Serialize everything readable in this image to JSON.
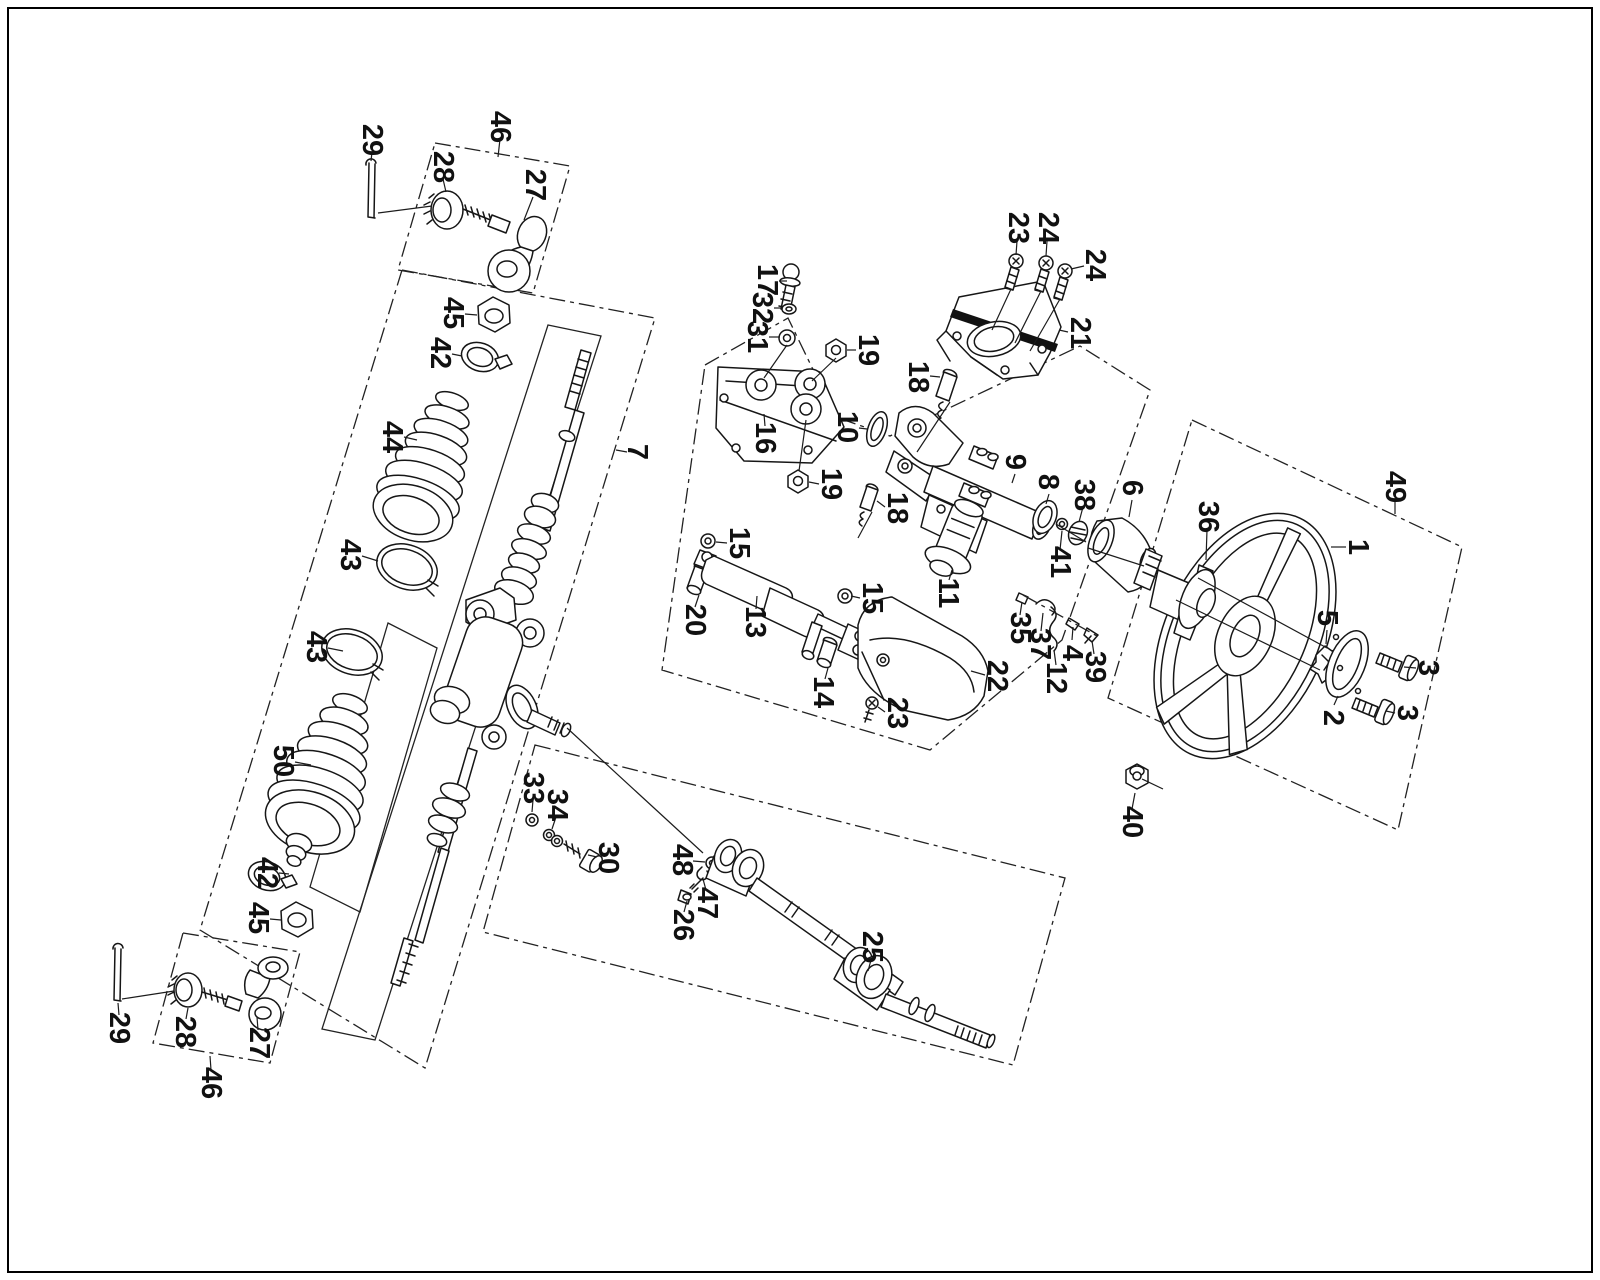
{
  "figure": {
    "title": "steering-system-exploded-parts-diagram",
    "width": 1600,
    "height": 1280,
    "background": "#ffffff",
    "ink": "#161616",
    "border": {
      "x": 8,
      "y": 8,
      "w": 1584,
      "h": 1264
    }
  },
  "labels": [
    {
      "t": "29",
      "x": 372,
      "y": 140,
      "l": [
        372,
        152,
        371,
        161
      ]
    },
    {
      "t": "46",
      "x": 500,
      "y": 127,
      "l": [
        500,
        139,
        498,
        157
      ]
    },
    {
      "t": "28",
      "x": 443,
      "y": 167,
      "l": [
        443,
        179,
        446,
        192
      ]
    },
    {
      "t": "27",
      "x": 535,
      "y": 185,
      "l": [
        533,
        197,
        524,
        220
      ]
    },
    {
      "t": "45",
      "x": 453,
      "y": 313,
      "l": [
        465,
        314,
        477,
        315
      ]
    },
    {
      "t": "42",
      "x": 440,
      "y": 353,
      "l": [
        452,
        354,
        462,
        356
      ]
    },
    {
      "t": "44",
      "x": 392,
      "y": 437,
      "l": [
        404,
        437,
        417,
        440
      ]
    },
    {
      "t": "43",
      "x": 350,
      "y": 555,
      "l": [
        362,
        556,
        378,
        561
      ]
    },
    {
      "t": "43",
      "x": 316,
      "y": 647,
      "l": [
        328,
        648,
        343,
        651
      ]
    },
    {
      "t": "50",
      "x": 283,
      "y": 761,
      "l": [
        295,
        762,
        311,
        765
      ]
    },
    {
      "t": "42",
      "x": 267,
      "y": 873,
      "l": [
        279,
        873,
        289,
        874
      ]
    },
    {
      "t": "45",
      "x": 258,
      "y": 918,
      "l": [
        270,
        919,
        281,
        920
      ]
    },
    {
      "t": "29",
      "x": 119,
      "y": 1028,
      "l": [
        119,
        1015,
        118,
        1003
      ]
    },
    {
      "t": "28",
      "x": 185,
      "y": 1032,
      "l": [
        186,
        1019,
        188,
        1008
      ]
    },
    {
      "t": "27",
      "x": 259,
      "y": 1043,
      "l": [
        258,
        1030,
        257,
        1017
      ]
    },
    {
      "t": "46",
      "x": 211,
      "y": 1083,
      "l": [
        211,
        1070,
        210,
        1056
      ]
    },
    {
      "t": "7",
      "x": 637,
      "y": 452,
      "l": [
        627,
        452,
        616,
        450
      ]
    },
    {
      "t": "17",
      "x": 767,
      "y": 280,
      "l": [
        779,
        281,
        787,
        281
      ]
    },
    {
      "t": "32",
      "x": 762,
      "y": 308,
      "l": [
        774,
        308,
        783,
        308
      ]
    },
    {
      "t": "31",
      "x": 757,
      "y": 337,
      "l": [
        769,
        337,
        780,
        337
      ]
    },
    {
      "t": "19",
      "x": 868,
      "y": 350,
      "l": [
        856,
        350,
        847,
        350
      ]
    },
    {
      "t": "16",
      "x": 765,
      "y": 438,
      "l": [
        765,
        426,
        764,
        414
      ]
    },
    {
      "t": "10",
      "x": 847,
      "y": 427,
      "l": [
        859,
        428,
        867,
        429
      ]
    },
    {
      "t": "19",
      "x": 831,
      "y": 484,
      "l": [
        819,
        484,
        809,
        482
      ]
    },
    {
      "t": "18",
      "x": 918,
      "y": 377,
      "l": [
        930,
        376,
        940,
        377
      ]
    },
    {
      "t": "18",
      "x": 897,
      "y": 508,
      "l": [
        885,
        507,
        877,
        501
      ]
    },
    {
      "t": "23",
      "x": 1018,
      "y": 228,
      "l": [
        1017,
        241,
        1016,
        255
      ]
    },
    {
      "t": "24",
      "x": 1048,
      "y": 228,
      "l": [
        1047,
        241,
        1046,
        256
      ]
    },
    {
      "t": "24",
      "x": 1095,
      "y": 265,
      "l": [
        1084,
        266,
        1071,
        269
      ]
    },
    {
      "t": "21",
      "x": 1080,
      "y": 333,
      "l": [
        1068,
        332,
        1059,
        330
      ]
    },
    {
      "t": "9",
      "x": 1015,
      "y": 462,
      "l": [
        1015,
        474,
        1012,
        483
      ]
    },
    {
      "t": "8",
      "x": 1048,
      "y": 482,
      "l": [
        1049,
        494,
        1046,
        504
      ]
    },
    {
      "t": "38",
      "x": 1084,
      "y": 495,
      "l": [
        1083,
        507,
        1079,
        522
      ]
    },
    {
      "t": "41",
      "x": 1060,
      "y": 562,
      "l": [
        1060,
        550,
        1062,
        531
      ]
    },
    {
      "t": "6",
      "x": 1132,
      "y": 488,
      "l": [
        1132,
        500,
        1129,
        517
      ]
    },
    {
      "t": "36",
      "x": 1208,
      "y": 517,
      "l": [
        1207,
        530,
        1206,
        560
      ]
    },
    {
      "t": "11",
      "x": 948,
      "y": 593,
      "l": [
        949,
        580,
        952,
        570
      ]
    },
    {
      "t": "15",
      "x": 739,
      "y": 543,
      "l": [
        727,
        543,
        716,
        542
      ]
    },
    {
      "t": "20",
      "x": 695,
      "y": 620,
      "l": [
        695,
        607,
        699,
        595
      ]
    },
    {
      "t": "13",
      "x": 755,
      "y": 622,
      "l": [
        756,
        609,
        757,
        596
      ]
    },
    {
      "t": "15",
      "x": 872,
      "y": 598,
      "l": [
        860,
        598,
        851,
        596
      ]
    },
    {
      "t": "14",
      "x": 823,
      "y": 692,
      "l": [
        825,
        679,
        828,
        668
      ]
    },
    {
      "t": "22",
      "x": 997,
      "y": 676,
      "l": [
        985,
        675,
        971,
        671
      ]
    },
    {
      "t": "23",
      "x": 897,
      "y": 713,
      "l": [
        885,
        712,
        878,
        707
      ]
    },
    {
      "t": "35",
      "x": 1020,
      "y": 628,
      "l": [
        1020,
        615,
        1022,
        602
      ]
    },
    {
      "t": "37",
      "x": 1040,
      "y": 644,
      "l": [
        1041,
        631,
        1043,
        613
      ]
    },
    {
      "t": "4",
      "x": 1072,
      "y": 653,
      "l": [
        1072,
        640,
        1073,
        627
      ]
    },
    {
      "t": "39",
      "x": 1095,
      "y": 667,
      "l": [
        1094,
        654,
        1092,
        641
      ]
    },
    {
      "t": "12",
      "x": 1056,
      "y": 678,
      "l": [
        1056,
        665,
        1054,
        650
      ]
    },
    {
      "t": "33",
      "x": 533,
      "y": 788,
      "l": [
        533,
        800,
        532,
        812
      ]
    },
    {
      "t": "34",
      "x": 557,
      "y": 805,
      "l": [
        556,
        817,
        552,
        829
      ]
    },
    {
      "t": "30",
      "x": 608,
      "y": 858,
      "l": [
        597,
        857,
        588,
        855
      ]
    },
    {
      "t": "48",
      "x": 682,
      "y": 860,
      "l": [
        693,
        861,
        705,
        862
      ]
    },
    {
      "t": "47",
      "x": 707,
      "y": 903,
      "l": [
        706,
        890,
        703,
        879
      ]
    },
    {
      "t": "26",
      "x": 683,
      "y": 925,
      "l": [
        684,
        912,
        687,
        901
      ]
    },
    {
      "t": "25",
      "x": 872,
      "y": 947,
      "l": [
        871,
        960,
        868,
        971
      ]
    },
    {
      "t": "49",
      "x": 1395,
      "y": 487,
      "l": [
        1395,
        499,
        1395,
        514
      ]
    },
    {
      "t": "1",
      "x": 1358,
      "y": 547,
      "l": [
        1346,
        547,
        1331,
        547
      ]
    },
    {
      "t": "5",
      "x": 1327,
      "y": 618,
      "l": [
        1327,
        630,
        1326,
        644
      ]
    },
    {
      "t": "2",
      "x": 1333,
      "y": 718,
      "l": [
        1334,
        705,
        1338,
        696
      ]
    },
    {
      "t": "3",
      "x": 1428,
      "y": 668,
      "l": [
        1416,
        668,
        1404,
        667
      ]
    },
    {
      "t": "3",
      "x": 1407,
      "y": 713,
      "l": [
        1395,
        713,
        1386,
        711
      ]
    },
    {
      "t": "40",
      "x": 1132,
      "y": 822,
      "l": [
        1132,
        809,
        1135,
        793
      ]
    }
  ],
  "leader_lines": {
    "solid": [
      [
        378,
        213,
        432,
        206
      ],
      [
        122,
        999,
        174,
        991
      ],
      [
        787,
        345,
        764,
        378
      ],
      [
        836,
        358,
        812,
        381
      ],
      [
        799,
        471,
        806,
        420
      ],
      [
        950,
        402,
        917,
        452
      ],
      [
        872,
        512,
        858,
        538
      ],
      [
        1011,
        289,
        992,
        330
      ],
      [
        1041,
        291,
        1015,
        343
      ],
      [
        1060,
        299,
        1030,
        351
      ],
      [
        567,
        728,
        703,
        853
      ],
      [
        1198,
        578,
        1327,
        648
      ],
      [
        1176,
        600,
        1320,
        670
      ],
      [
        1088,
        548,
        1144,
        566
      ],
      [
        1056,
        524,
        1086,
        542
      ],
      [
        1142,
        779,
        1163,
        789
      ]
    ],
    "dashdot": [
      [
        1023,
        595,
        1097,
        636
      ]
    ]
  },
  "construction_boxes": {
    "dashdot": [
      {
        "name": "box-tie-rod-assembly-top",
        "points": "435,143 570,166 533,293 398,270"
      },
      {
        "name": "box-rack-assembly",
        "points": "402,270 655,318 425,1068 200,930"
      },
      {
        "name": "box-tie-rod-assembly-bottom",
        "points": "183,933 300,952 270,1063 153,1043"
      },
      {
        "name": "box-column-assembly",
        "points": "705,365 788,318 836,417 890,436 1080,346 1150,390 1062,640 930,750 662,670"
      },
      {
        "name": "box-steering-wheel",
        "points": "1192,420 1462,547 1398,830 1108,698"
      },
      {
        "name": "box-intermediate-shaft",
        "points": "535,745 1065,878 1013,1065 483,932"
      }
    ],
    "solid": [
      {
        "name": "frame-rack-shaft",
        "points": "548,325 601,336 375,1040 322,1029"
      },
      {
        "name": "frame-lower-boot",
        "points": "388,623 437,648 360,912 310,887"
      }
    ]
  }
}
